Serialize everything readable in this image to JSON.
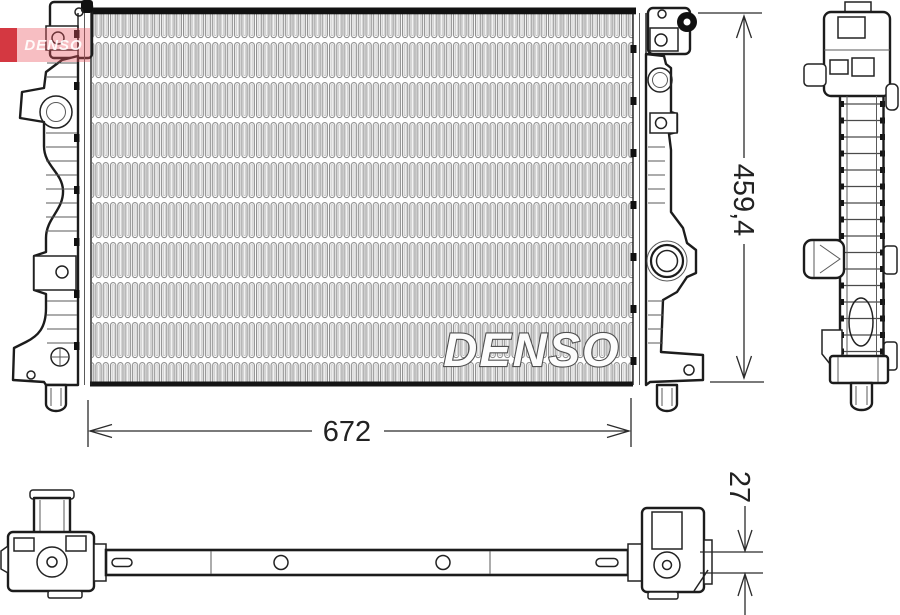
{
  "drawing": {
    "brand_watermark": "DENSO",
    "logo": {
      "text": "DENSO",
      "color_primary": "#ca121c",
      "color_band": "#e8545e"
    },
    "dimensions": {
      "width": {
        "label": "672"
      },
      "height": {
        "label": "459,4"
      },
      "depth": {
        "label": "27"
      }
    },
    "colors": {
      "outline": "#1c1c1c",
      "fins": "#8e8e8e",
      "dimension_lines": "#2b2b2b"
    }
  }
}
